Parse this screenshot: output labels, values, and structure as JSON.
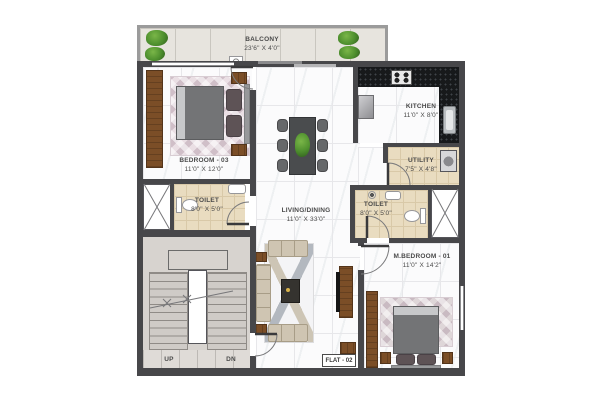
{
  "flat_badge": "FLAT - 02",
  "rooms": {
    "balcony": {
      "name": "BALCONY",
      "dims": "23'6\" X 4'0\""
    },
    "bedroom3": {
      "name": "BEDROOM - 03",
      "dims": "11'0\" X 12'0\""
    },
    "toilet_a": {
      "name": "TOILET",
      "dims": "8'0\" X 5'0\""
    },
    "living": {
      "name": "LIVING/DINING",
      "dims": "11'0\" X 33'0\""
    },
    "kitchen": {
      "name": "KITCHEN",
      "dims": "11'0\" X 8'0\""
    },
    "utility": {
      "name": "UTILITY",
      "dims": "7'5\" X 4'8\""
    },
    "toilet_b": {
      "name": "TOILET",
      "dims": "8'0\" X 5'0\""
    },
    "master": {
      "name": "M.BEDROOM - 01",
      "dims": "11'0\" X 14'2\""
    }
  },
  "stairs": {
    "up": "UP",
    "down": "DN"
  },
  "fixtures": [
    "double-bed",
    "wardrobe",
    "bedside-table",
    "dining-table",
    "dining-chair",
    "potted-plant",
    "sofa",
    "coffee-table",
    "tv-unit",
    "kitchen-counter",
    "gas-stove",
    "kitchen-sink",
    "refrigerator",
    "washing-machine",
    "wash-basin",
    "water-closet",
    "shower",
    "staircase",
    "ventilation-shaft",
    "door-swing"
  ],
  "colors": {
    "wall": "#47474a",
    "wall_light": "#9b9b9b",
    "wood": "#7b4e27",
    "granite_counter": "#17191b",
    "marble_floor": "#fbfbfc",
    "toilet_tile": "#e9dcc0",
    "balcony_tile": "#e7e4de",
    "stair": "#cfcbc7",
    "sofa": "#cfc5b2",
    "bed_linen": "#737476",
    "pillow": "#5e5356",
    "rug": "#eadfe4",
    "plant": "#4e8f2e",
    "text": "#4a4a4a"
  }
}
